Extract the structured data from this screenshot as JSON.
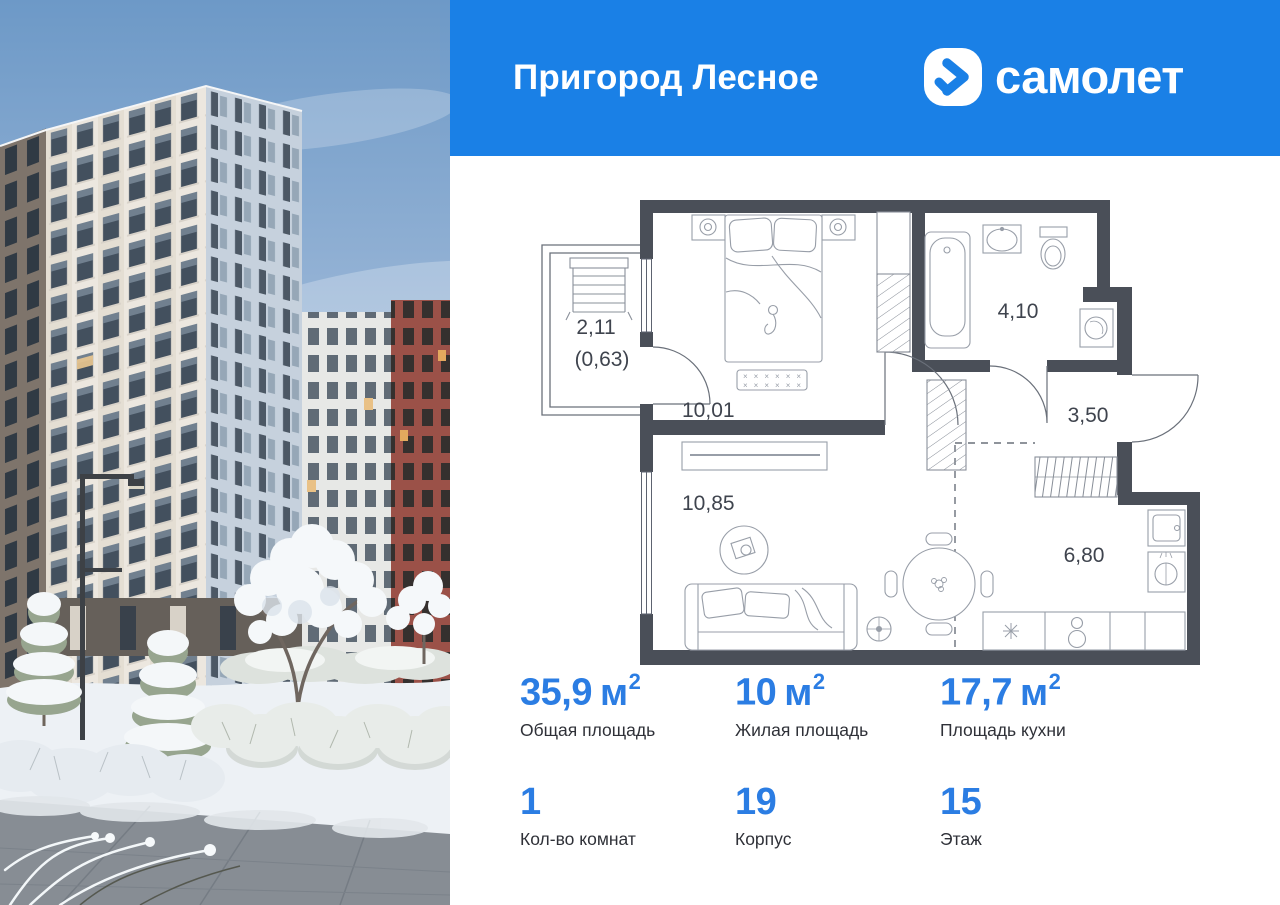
{
  "header": {
    "project_title": "Пригород Лесное",
    "brand_name": "самолет"
  },
  "colors": {
    "header_bg": "#1a80e6",
    "accent_blue": "#2b7de3",
    "wall_color": "#4a4f58",
    "plan_label_color": "#3f444e"
  },
  "floor_plan": {
    "rooms": [
      {
        "id": "bedroom",
        "area": "10,01"
      },
      {
        "id": "living-room",
        "area": "10,85"
      },
      {
        "id": "bathroom",
        "area": "4,10"
      },
      {
        "id": "hallway",
        "area": "3,50"
      },
      {
        "id": "kitchen-dining",
        "area": "6,80"
      },
      {
        "id": "balcony",
        "area": "2,11",
        "area_reduced": "(0,63)"
      }
    ]
  },
  "stats": {
    "items": [
      {
        "value": "35,9",
        "unit": "м",
        "sup": "2",
        "label": "Общая площадь"
      },
      {
        "value": "10",
        "unit": "м",
        "sup": "2",
        "label": "Жилая площадь"
      },
      {
        "value": "17,7",
        "unit": "м",
        "sup": "2",
        "label": "Площадь кухни"
      },
      {
        "value": "1",
        "unit": "",
        "sup": "",
        "label": "Кол-во комнат"
      },
      {
        "value": "19",
        "unit": "",
        "sup": "",
        "label": "Корпус"
      },
      {
        "value": "15",
        "unit": "",
        "sup": "",
        "label": "Этаж"
      }
    ]
  }
}
